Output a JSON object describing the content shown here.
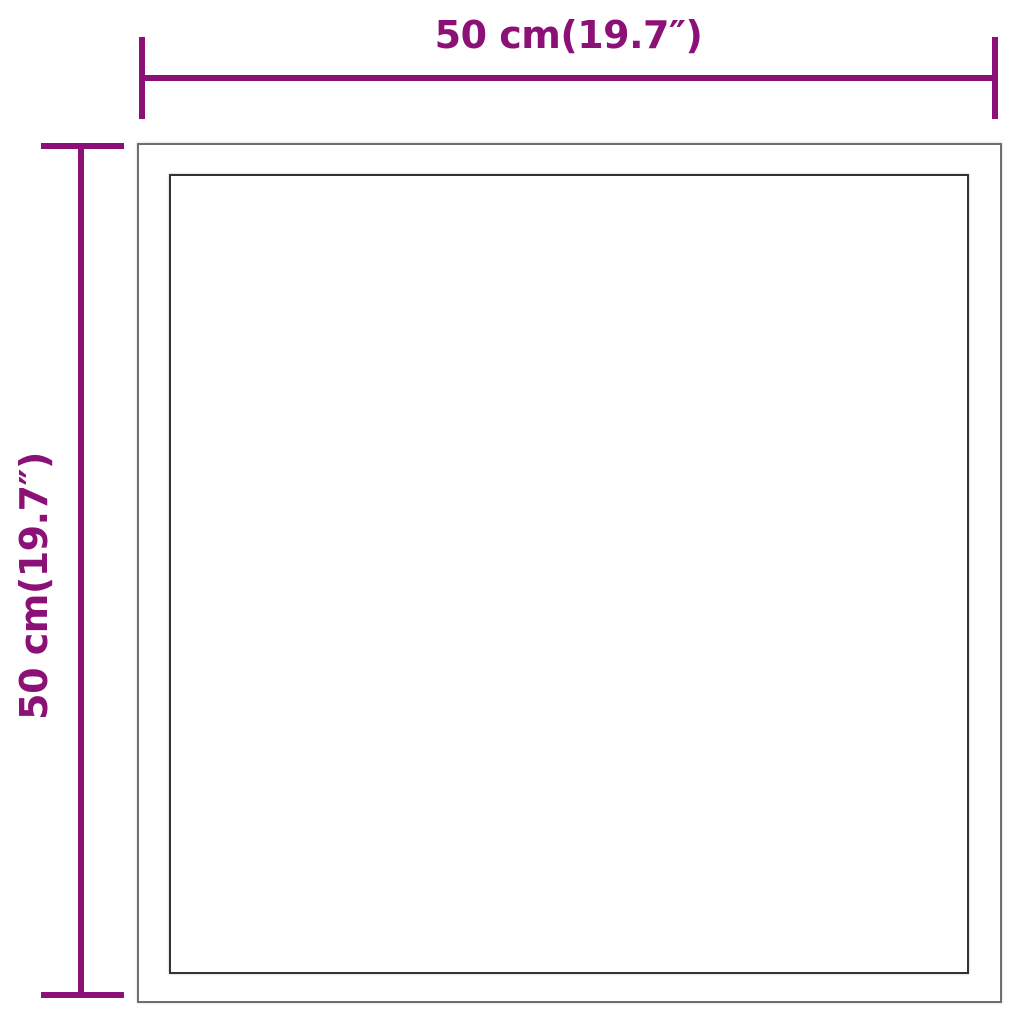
{
  "diagram": {
    "product": "square-frame-with-inner-panel",
    "width_dimension": {
      "label": "50 cm(19.7″)"
    },
    "height_dimension": {
      "label": "50 cm(19.7″)"
    }
  },
  "colors": {
    "dimension_color": "#8b1176",
    "outer_frame_color": "#6f6f6f",
    "inner_frame_color": "#333333",
    "background": "#ffffff"
  }
}
